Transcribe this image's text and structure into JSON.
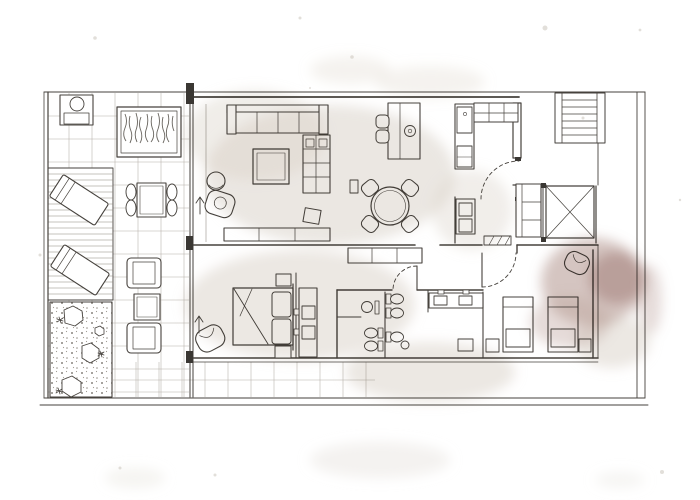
{
  "meta": {
    "kind": "hand-drawn watercolor apartment floor plan sketch",
    "orientation": "terrace on left, entrance and stair core on right",
    "visible_text": "none"
  },
  "palette": {
    "paper": "#ffffff",
    "ink": "#46423d",
    "grid_line": "#a8a198",
    "wash_beige": "#d8cfc5",
    "wash_taupe": "#d5ccc2",
    "wash_light": "#ddd5cb",
    "wash_mauve": "#ab8b83",
    "wash_mauve_dark": "#96716a",
    "wash_mauve_light": "#bfa59e",
    "pillar_dark": "#3a3733"
  },
  "rooms": [
    {
      "id": "terrace",
      "furniture": [
        "bbq-unit",
        "planter-bed",
        "wood-deck",
        "sun-lounger",
        "sun-lounger",
        "outdoor-dining-table",
        "outdoor-chairs",
        "outdoor-armchair",
        "outdoor-side-table",
        "outdoor-armchair",
        "pebble-garden",
        "rocks"
      ]
    },
    {
      "id": "living-room",
      "furniture": [
        "sofa",
        "coffee-table",
        "pouf",
        "armchair",
        "shelving-unit",
        "side-table",
        "sideboard"
      ]
    },
    {
      "id": "dining-area",
      "furniture": [
        "round-table",
        "chair",
        "chair",
        "chair",
        "chair",
        "wall-shelf"
      ]
    },
    {
      "id": "kitchen",
      "furniture": [
        "peninsula-counter",
        "sink",
        "bar-stool",
        "bar-stool",
        "tall-unit-fridge",
        "wall-cabinets"
      ]
    },
    {
      "id": "entry-hall",
      "furniture": [
        "entry-door",
        "entry-closet",
        "laundry-unit",
        "doormat",
        "hall-console"
      ]
    },
    {
      "id": "master-bedroom",
      "furniture": [
        "double-bed",
        "nightstand",
        "nightstand",
        "armchair",
        "wardrobe-drawers"
      ]
    },
    {
      "id": "bathroom-1",
      "furniture": [
        "washbasin",
        "toilet",
        "toilet"
      ]
    },
    {
      "id": "bathroom-2",
      "furniture": [
        "toilet",
        "toilet",
        "toilet",
        "bidet"
      ]
    },
    {
      "id": "vanity-area",
      "furniture": [
        "double-washbasin-counter"
      ]
    },
    {
      "id": "bedroom-2",
      "furniture": [
        "single-bed",
        "single-bed",
        "lounge-chair",
        "side-table",
        "side-table",
        "side-table",
        "door"
      ]
    },
    {
      "id": "stairwell",
      "furniture": [
        "stairs"
      ]
    },
    {
      "id": "elevator",
      "furniture": [
        "elevator-cab-x-symbol"
      ]
    }
  ],
  "symbols": [
    "door-swing-arc",
    "entry-arrow",
    "wall-pillar",
    "tile-grid",
    "deck-planks",
    "pebble-dots"
  ]
}
